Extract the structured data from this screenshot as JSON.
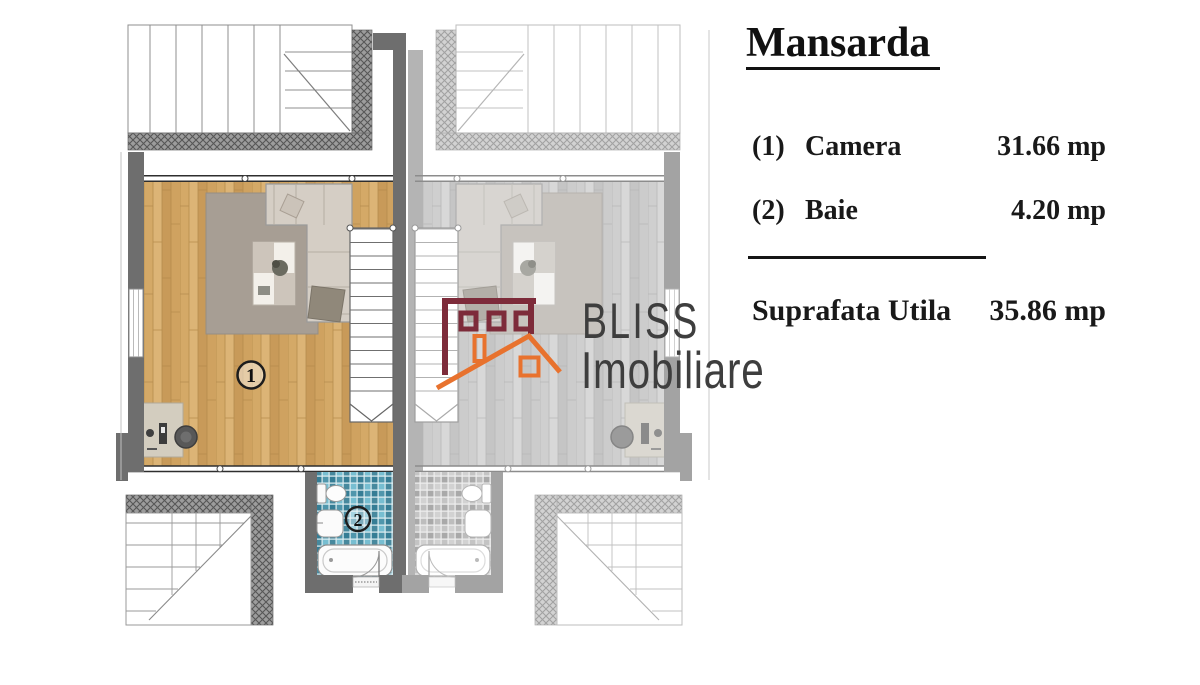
{
  "panel": {
    "title": "Mansarda",
    "items": [
      {
        "num": "(1)",
        "label": "Camera",
        "value": "31.66 mp"
      },
      {
        "num": "(2)",
        "label": "Baie",
        "value": "4.20 mp"
      }
    ],
    "total_label": "Suprafata Utila",
    "total_value": "35.86 mp"
  },
  "logo": {
    "brand": "BLISS",
    "subbrand": "Imobiliare"
  },
  "plan": {
    "room1_label": "1",
    "room2_label": "2"
  },
  "colors": {
    "logo_maroon": "#7d2b3a",
    "logo_orange": "#e8722e",
    "logo_text": "#3e3e3e",
    "wall_dark": "#6e6e6e",
    "wall_light": "#a3a3a3",
    "wood": "#d4a967",
    "tile_blue": "#4f96ac",
    "divider": "#151515"
  }
}
